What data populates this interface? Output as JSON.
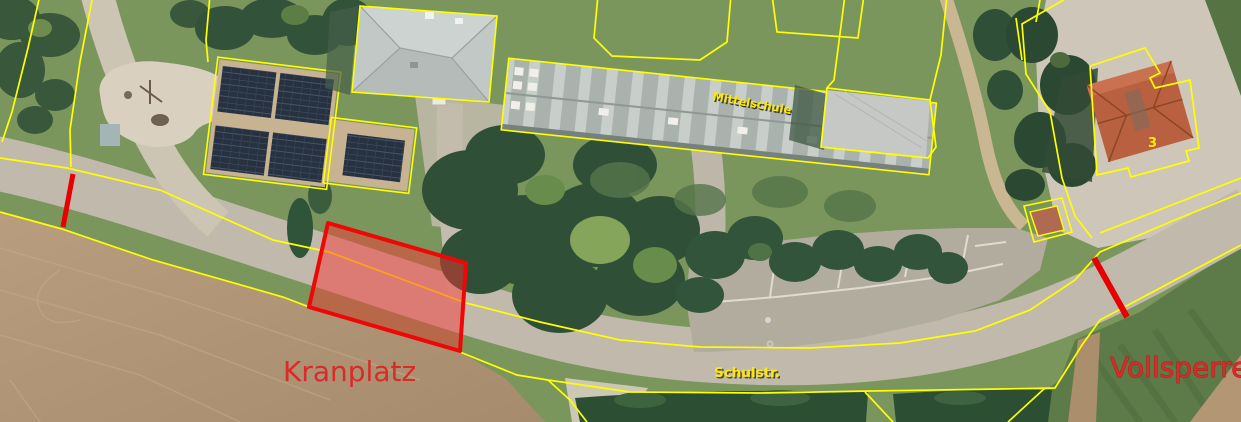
{
  "map": {
    "description": "aerial-orthophoto-with-cadastral-overlay",
    "labels": {
      "crane_area": "Kranplatz",
      "closure": "Vollsperre:",
      "school_building": "Mittelschule",
      "street": "Schulstr.",
      "house_number": "3"
    },
    "colors": {
      "parcel_line": "#ffff00",
      "closure_red": "#e60000",
      "annotation_red": "#da2a2a",
      "map_label_yellow": "#ffe900",
      "crane_border": "#ee0707"
    }
  }
}
